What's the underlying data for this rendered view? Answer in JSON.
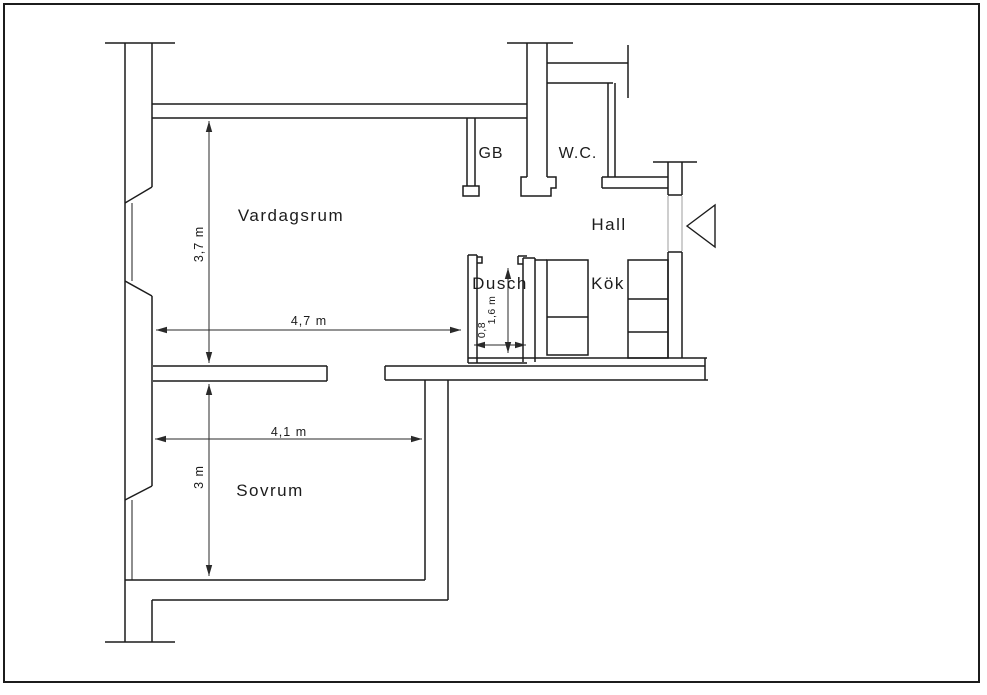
{
  "rooms": {
    "vardagsrum": "Vardagsrum",
    "sovrum": "Sovrum",
    "dusch": "Dusch",
    "hall": "Hall",
    "kok": "Kök",
    "wc": "W.C.",
    "gb": "GB"
  },
  "dimensions": {
    "vardagsrum_width": "4,7 m",
    "vardagsrum_depth": "3,7 m",
    "sovrum_width": "4,1 m",
    "sovrum_depth": "3 m",
    "dusch_depth": "1,6 m",
    "dusch_width": "0,8"
  },
  "colors": {
    "line": "#1c1c1c",
    "dimension_line": "#2a2a2a",
    "door_opening_line": "#9c9c9c",
    "background": "#ffffff"
  }
}
